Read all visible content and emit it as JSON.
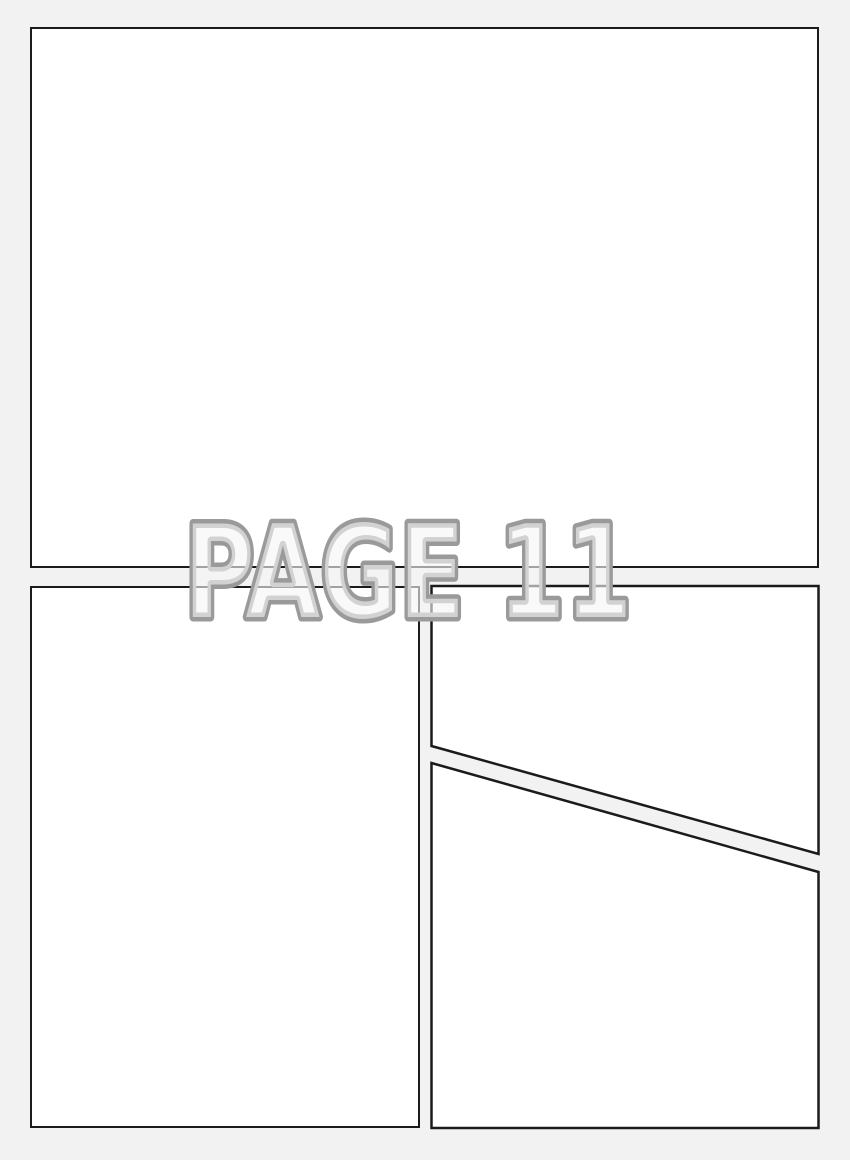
{
  "page_label": {
    "text": "PAGE 11"
  },
  "colors": {
    "background": "#f2f2f2",
    "panel_fill": "#ffffff",
    "panel_border": "#1b1b1b",
    "label_outline": "#9a9a9a",
    "label_fill": "#f5f5f5"
  },
  "panels": [
    {
      "name": "comic-panel-1",
      "position": "top-full-width"
    },
    {
      "name": "comic-panel-2",
      "position": "bottom-left"
    },
    {
      "name": "comic-panel-3",
      "position": "bottom-right-upper"
    },
    {
      "name": "comic-panel-4",
      "position": "bottom-right-lower"
    }
  ]
}
